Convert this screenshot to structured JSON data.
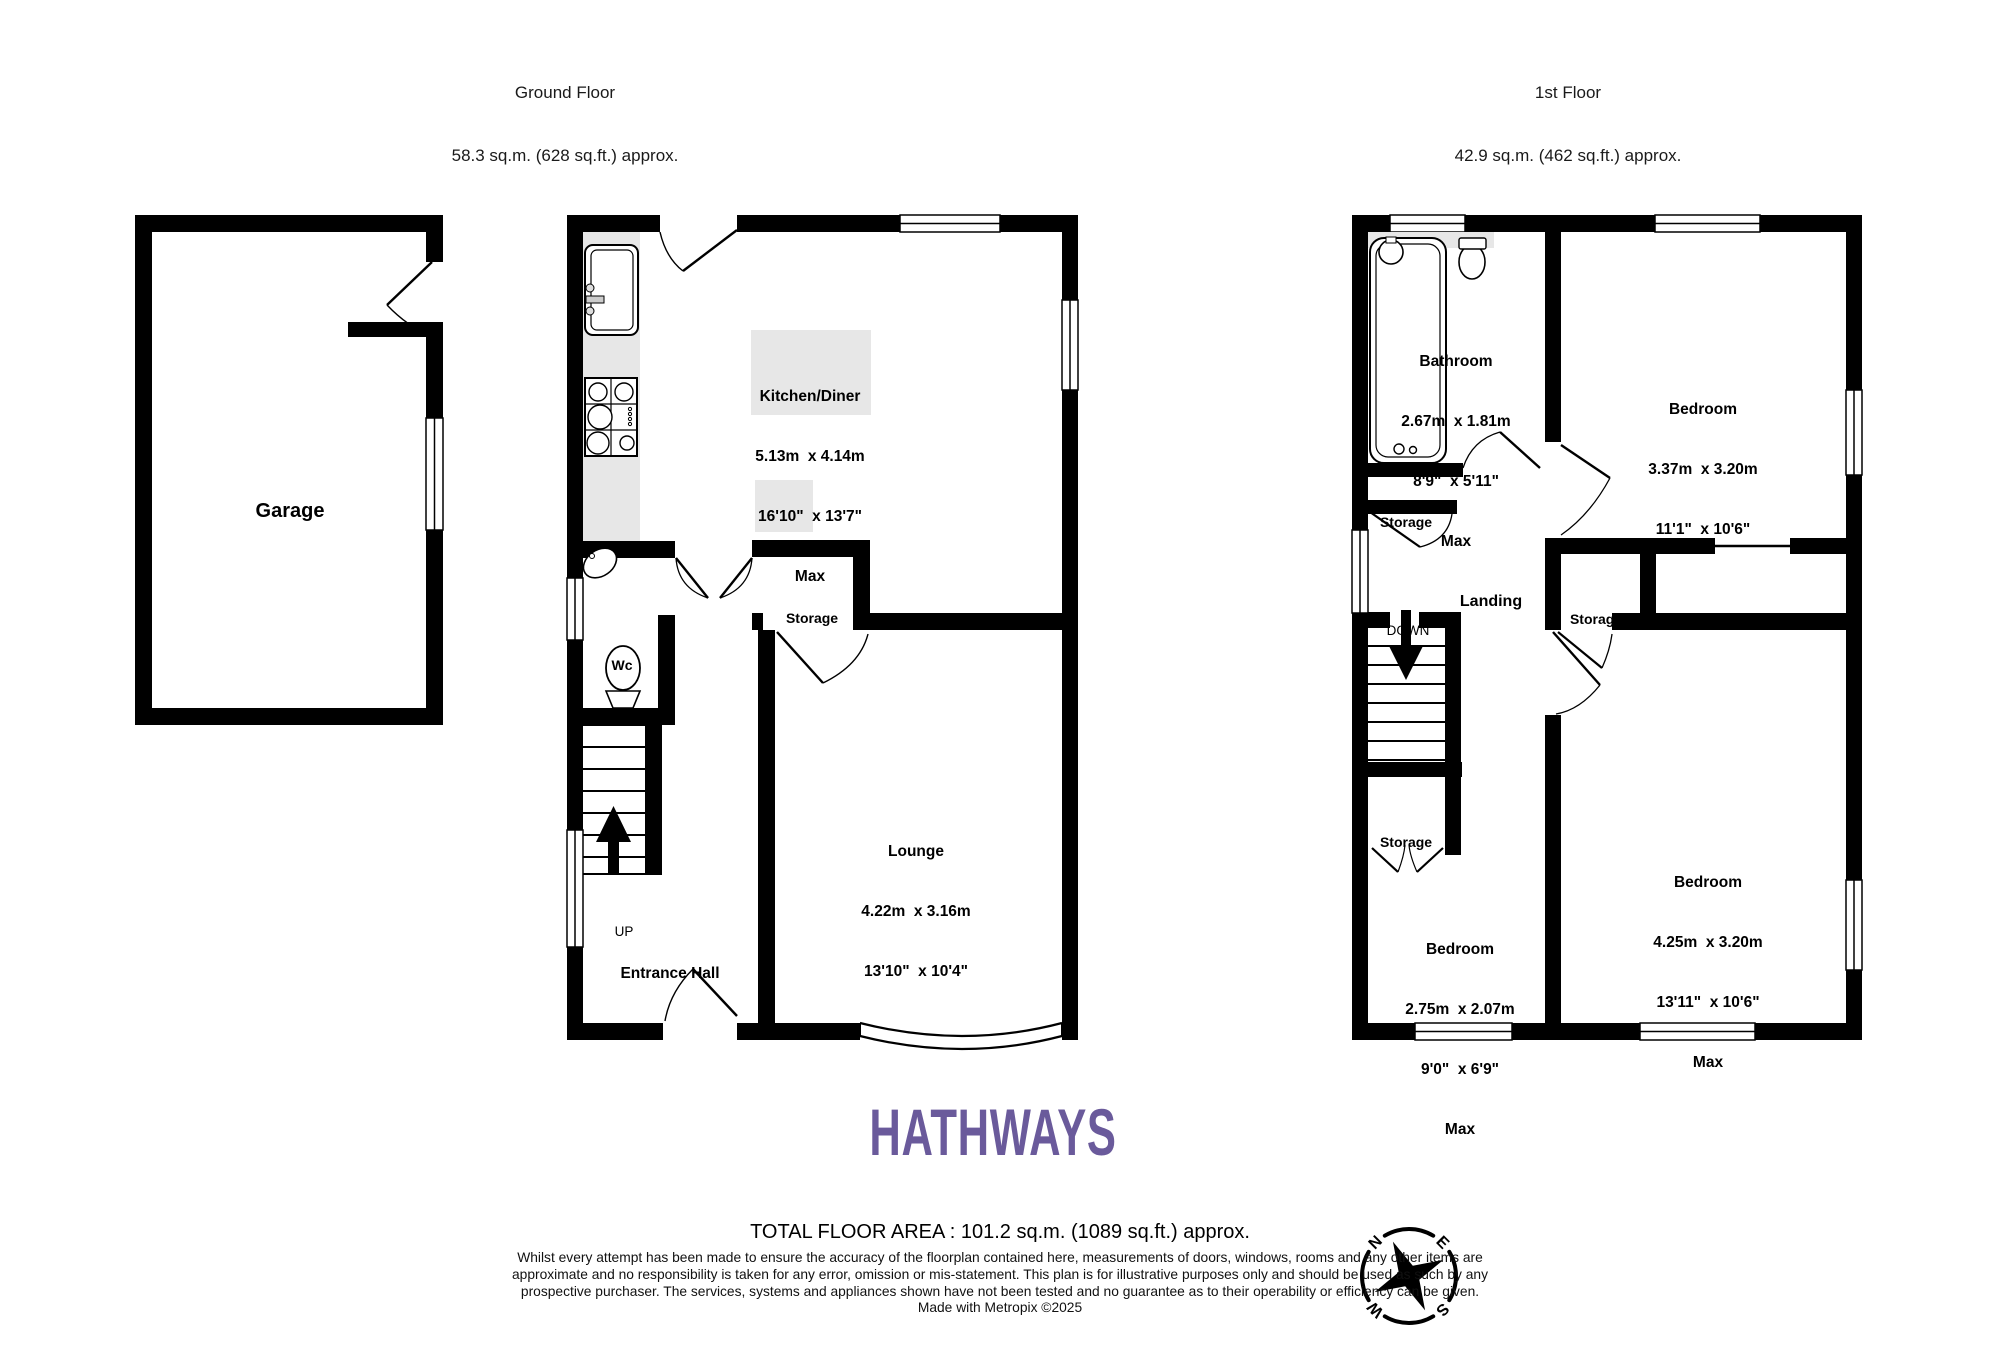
{
  "headers": {
    "ground": {
      "title": "Ground Floor",
      "area": "58.3 sq.m. (628 sq.ft.) approx."
    },
    "first": {
      "title": "1st Floor",
      "area": "42.9 sq.m. (462 sq.ft.) approx."
    }
  },
  "ground_floor": {
    "garage": {
      "name": "Garage"
    },
    "kitchen": {
      "name": "Kitchen/Diner",
      "dims_m": "5.13m  x 4.14m",
      "dims_ft": "16'10\"  x 13'7\"",
      "max": "Max"
    },
    "storage": {
      "name": "Storage"
    },
    "wc": {
      "name": "Wc"
    },
    "lounge": {
      "name": "Lounge",
      "dims_m": "4.22m  x 3.16m",
      "dims_ft": "13'10\"  x 10'4\""
    },
    "stairs": {
      "up": "UP"
    },
    "entrance_hall": {
      "name": "Entrance Hall"
    }
  },
  "first_floor": {
    "bathroom": {
      "name": "Bathroom",
      "dims_m": "2.67m  x 1.81m",
      "dims_ft": "8'9\"  x 5'11\"",
      "max": "Max"
    },
    "bedroom_top_right": {
      "name": "Bedroom",
      "dims_m": "3.37m  x 3.20m",
      "dims_ft": "11'1\"  x 10'6\""
    },
    "bedroom_bottom_left": {
      "name": "Bedroom",
      "dims_m": "2.75m  x 2.07m",
      "dims_ft": "9'0\"  x 6'9\"",
      "max": "Max"
    },
    "bedroom_bottom_right": {
      "name": "Bedroom",
      "dims_m": "4.25m  x 3.20m",
      "dims_ft": "13'11\"  x 10'6\"",
      "max": "Max"
    },
    "storage_under_bathroom": {
      "name": "Storage"
    },
    "storage_landing_left": {
      "name": "Storage"
    },
    "storage_landing_right": {
      "name": "Storage"
    },
    "storage_under_stairs": {
      "name": "Storage"
    },
    "landing": {
      "name": "Landing"
    },
    "stairs": {
      "down": "DOWN"
    }
  },
  "branding": {
    "logo_text": "HATHWAYS",
    "logo_color": "#6a5a9b"
  },
  "footer": {
    "total_area": "TOTAL FLOOR AREA : 101.2 sq.m. (1089 sq.ft.) approx.",
    "disclaimer": "Whilst every attempt has been made to ensure the accuracy of the floorplan contained here, measurements of doors, windows, rooms and any other items are approximate and no responsibility is taken for any error, omission or mis-statement. This plan is for illustrative purposes only and should be used as such by any prospective purchaser. The services, systems and appliances shown have not been tested and no guarantee as to their operability or efficiency can be given.",
    "credit": "Made with Metropix ©2025"
  },
  "compass": {
    "north": "N",
    "east": "E",
    "south": "S",
    "west": "W"
  }
}
